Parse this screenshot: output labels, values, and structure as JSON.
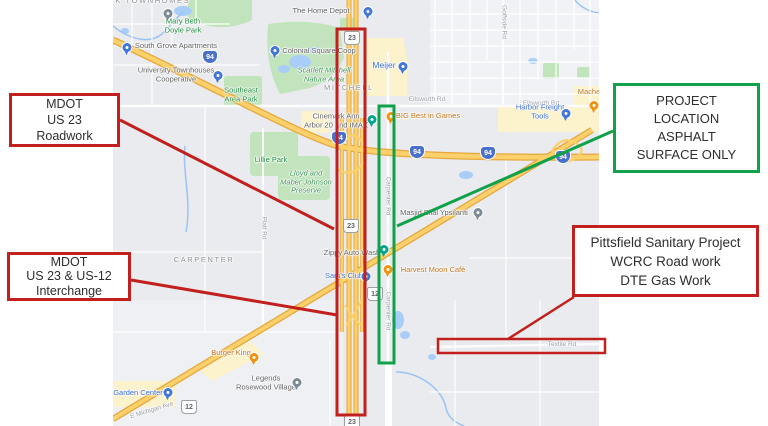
{
  "callouts": {
    "roadwork": {
      "lines": [
        "MDOT",
        "US 23",
        "Roadwork"
      ]
    },
    "interchange": {
      "lines": [
        "MDOT",
        "US 23 & US-12",
        "Interchange"
      ]
    },
    "project": {
      "lines": [
        "PROJECT",
        "LOCATION",
        "ASPHALT",
        "SURFACE ONLY"
      ]
    },
    "pittsfield": {
      "lines": [
        "Pittsfield Sanitary Project",
        "WCRC Road work",
        "DTE Gas Work"
      ]
    }
  },
  "colors": {
    "annotation_red": "#c2201f",
    "annotation_green": "#12a14b",
    "highway_yellow": "#fcd06a",
    "park_green": "#c2e4bd",
    "water_blue": "#a8cdf8",
    "commercial_cream": "#fcf3cd",
    "map_background": "#e9ebee"
  },
  "map": {
    "labels": [
      {
        "t": "ECK TOWNHOMES",
        "x": 146,
        "y": 1,
        "c": "hood"
      },
      {
        "t": "The Home Depot",
        "x": 321,
        "y": 11,
        "c": "biz"
      },
      {
        "t": "Mary Beth\nDoyle Park",
        "x": 183,
        "y": 26,
        "c": "park"
      },
      {
        "t": "South Grove Apartments",
        "x": 176,
        "y": 46,
        "c": "biz"
      },
      {
        "t": "Colonial Square Coop",
        "x": 319,
        "y": 51,
        "c": "biz"
      },
      {
        "t": "Meijer",
        "x": 384,
        "y": 65,
        "c": "blue",
        "fs": 8.5
      },
      {
        "t": "University Townhouses\nCooperative",
        "x": 176,
        "y": 75,
        "c": "biz"
      },
      {
        "t": "Scarlett Mitchell\nNature Area",
        "x": 324,
        "y": 75,
        "c": "parki"
      },
      {
        "t": "Southeast\nArea Park",
        "x": 241,
        "y": 95,
        "c": "park"
      },
      {
        "t": "MITCHELL",
        "x": 349,
        "y": 88,
        "c": "hood"
      },
      {
        "t": "Ellsworth Rd",
        "x": 427,
        "y": 100,
        "c": "road"
      },
      {
        "t": "Ellsworth Rd",
        "x": 541,
        "y": 104,
        "c": "road"
      },
      {
        "t": "Mache",
        "x": 589,
        "y": 92,
        "c": "food"
      },
      {
        "t": "Harbor Freight Tools",
        "x": 540,
        "y": 112,
        "c": "blue"
      },
      {
        "t": "BIG Best in Games",
        "x": 428,
        "y": 116,
        "c": "food"
      },
      {
        "t": "Cinemark Ann\nArbor 20 and IMAX",
        "x": 336,
        "y": 121,
        "c": "biz"
      },
      {
        "t": "Lillie Park",
        "x": 271,
        "y": 160,
        "c": "park"
      },
      {
        "t": "Lloyd and\nMaber Johnson\nPreserve",
        "x": 306,
        "y": 182,
        "c": "parki"
      },
      {
        "t": "Masjid Bilal Ypsilanti",
        "x": 434,
        "y": 213,
        "c": "biz"
      },
      {
        "t": "Platt Rd",
        "x": 263,
        "y": 228,
        "c": "road",
        "r": 90
      },
      {
        "t": "Carpenter Rd",
        "x": 387,
        "y": 196,
        "c": "road",
        "r": 90
      },
      {
        "t": "Carpenter Rd",
        "x": 387,
        "y": 311,
        "c": "road",
        "r": 90
      },
      {
        "t": "Golfside Rd",
        "x": 503,
        "y": 22,
        "c": "road",
        "r": 90
      },
      {
        "t": "CARPENTER",
        "x": 204,
        "y": 260,
        "c": "hood"
      },
      {
        "t": "Zippy Auto Wash",
        "x": 352,
        "y": 253,
        "c": "biz"
      },
      {
        "t": "Sam's Club",
        "x": 344,
        "y": 276,
        "c": "blue"
      },
      {
        "t": "Harvest Moon Café",
        "x": 433,
        "y": 270,
        "c": "food"
      },
      {
        "t": "Burger King",
        "x": 231,
        "y": 353,
        "c": "food"
      },
      {
        "t": "Legends\nRosewood Village",
        "x": 266,
        "y": 383,
        "c": "biz"
      },
      {
        "t": "Garden Center",
        "x": 138,
        "y": 393,
        "c": "blue"
      },
      {
        "t": "E Michigan Ave",
        "x": 152,
        "y": 411,
        "c": "road",
        "r": -17
      },
      {
        "t": "Textile Rd",
        "x": 562,
        "y": 345,
        "c": "road"
      }
    ],
    "pins": [
      {
        "x": 368,
        "y": 16,
        "c": "blue",
        "n": "the-home-depot"
      },
      {
        "x": 168,
        "y": 18,
        "c": "gray",
        "n": "mary-beth-doyle-park"
      },
      {
        "x": 127,
        "y": 52,
        "c": "blue",
        "n": "south-grove-apartments"
      },
      {
        "x": 275,
        "y": 55,
        "c": "blue",
        "n": "colonial-square-coop"
      },
      {
        "x": 218,
        "y": 80,
        "c": "blue",
        "n": "university-townhouses"
      },
      {
        "x": 403,
        "y": 71,
        "c": "blue",
        "n": "meijer"
      },
      {
        "x": 372,
        "y": 124,
        "c": "teal",
        "n": "cinemark"
      },
      {
        "x": 391,
        "y": 121,
        "c": "orange",
        "n": "big-best-in-games"
      },
      {
        "x": 594,
        "y": 110,
        "c": "orange",
        "n": "macheko"
      },
      {
        "x": 566,
        "y": 118,
        "c": "blue",
        "n": "harbor-freight-tools"
      },
      {
        "x": 478,
        "y": 217,
        "c": "gray",
        "n": "masjid-bilal-ypsilanti"
      },
      {
        "x": 384,
        "y": 254,
        "c": "teal",
        "n": "zippy-auto-wash"
      },
      {
        "x": 366,
        "y": 281,
        "c": "blue",
        "n": "sams-club"
      },
      {
        "x": 388,
        "y": 274,
        "c": "orange",
        "n": "harvest-moon-cafe"
      },
      {
        "x": 254,
        "y": 362,
        "c": "orange",
        "n": "burger-king"
      },
      {
        "x": 297,
        "y": 387,
        "c": "gray",
        "n": "legends-rosewood-village"
      },
      {
        "x": 168,
        "y": 397,
        "c": "blue",
        "n": "garden-center"
      }
    ],
    "shields": [
      {
        "k": "i",
        "n": "94",
        "x": 210,
        "y": 57
      },
      {
        "k": "i",
        "n": "94",
        "x": 339,
        "y": 138
      },
      {
        "k": "i",
        "n": "94",
        "x": 417,
        "y": 152
      },
      {
        "k": "i",
        "n": "94",
        "x": 488,
        "y": 153
      },
      {
        "k": "i",
        "n": "94",
        "x": 563,
        "y": 157
      },
      {
        "k": "us",
        "n": "23",
        "x": 352,
        "y": 38
      },
      {
        "k": "us",
        "n": "23",
        "x": 351,
        "y": 226
      },
      {
        "k": "us",
        "n": "23",
        "x": 352,
        "y": 422
      },
      {
        "k": "us",
        "n": "12",
        "x": 375,
        "y": 294
      },
      {
        "k": "us",
        "n": "12",
        "x": 189,
        "y": 407
      }
    ]
  }
}
